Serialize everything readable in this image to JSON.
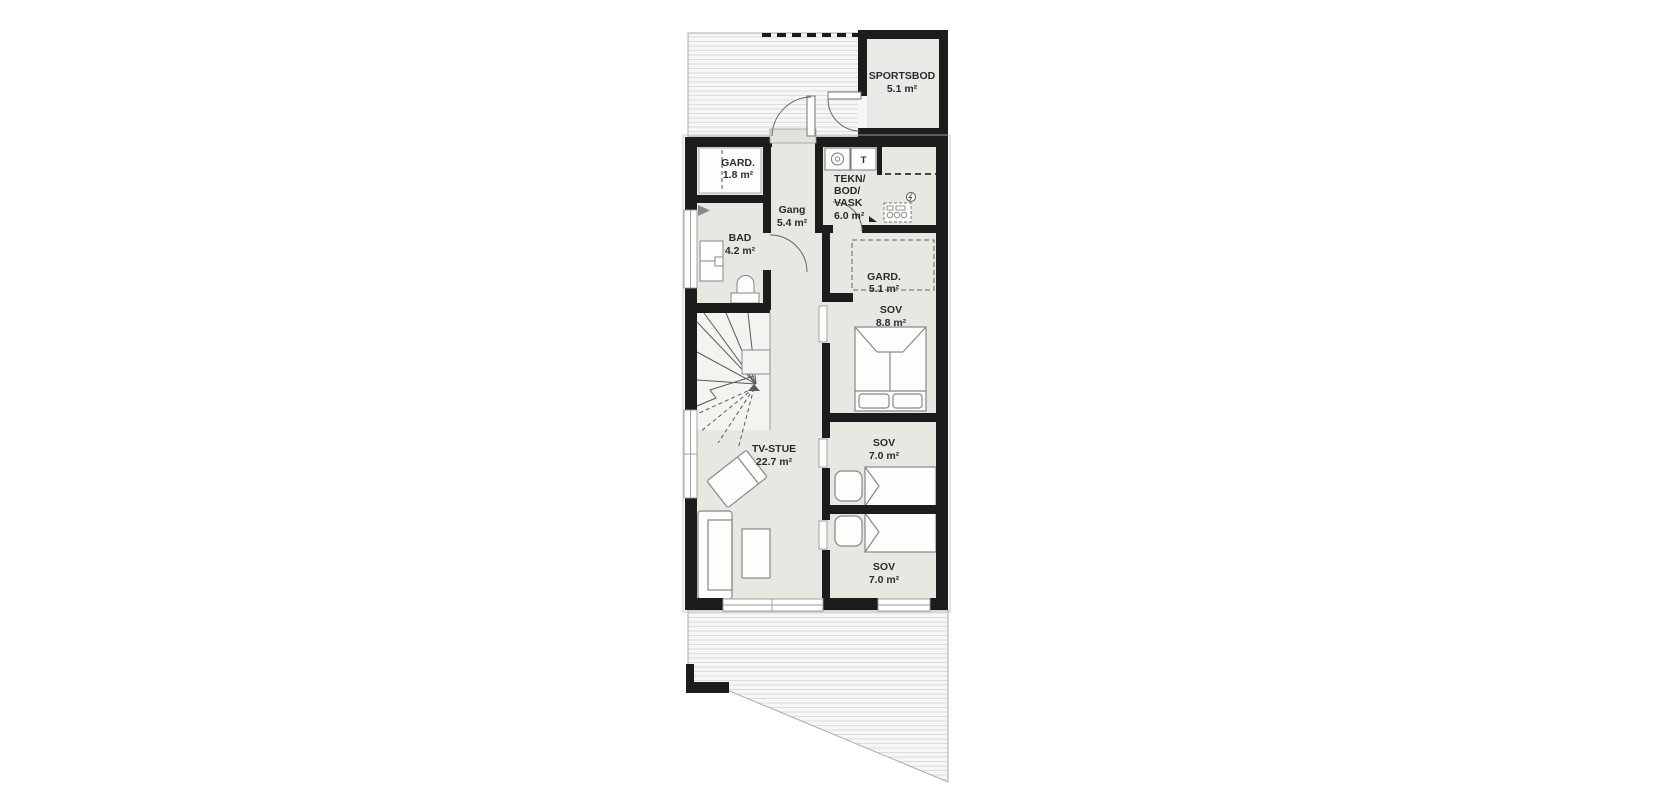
{
  "plan": {
    "rooms": {
      "sportsbod": {
        "name": "SPORTSBOD",
        "area": "5.1 m²"
      },
      "gard_entry": {
        "name": "GARD.",
        "area": "1.8 m²"
      },
      "gang": {
        "name": "Gang",
        "area": "5.4 m²"
      },
      "tekn": {
        "line1": "TEKN/",
        "line2": "BOD/",
        "line3": "VASK",
        "area": "6.0 m²"
      },
      "bad": {
        "name": "BAD",
        "area": "4.2 m²"
      },
      "gard_sov": {
        "name": "GARD.",
        "area": "5.1 m²"
      },
      "sov_main": {
        "name": "SOV",
        "area": "8.8 m²"
      },
      "tv_stue": {
        "name": "TV-STUE",
        "area": "22.7 m²"
      },
      "sov_mid": {
        "name": "SOV",
        "area": "7.0 m²"
      },
      "sov_lower": {
        "name": "SOV",
        "area": "7.0 m²"
      }
    },
    "appliances": {
      "dryer": "T"
    },
    "colors": {
      "wall": "#1c1c1c",
      "interior": "#e8e7e2",
      "room_white": "#fdfdfc",
      "sportsbod_fill": "#eae9e5",
      "deck_fill": "#f6f6f4",
      "deck_stripe": "#dcdcd8",
      "stairs_fill": "#f3f3f0",
      "furniture_stroke": "#878785",
      "label_text": "#2b2b2b"
    }
  }
}
